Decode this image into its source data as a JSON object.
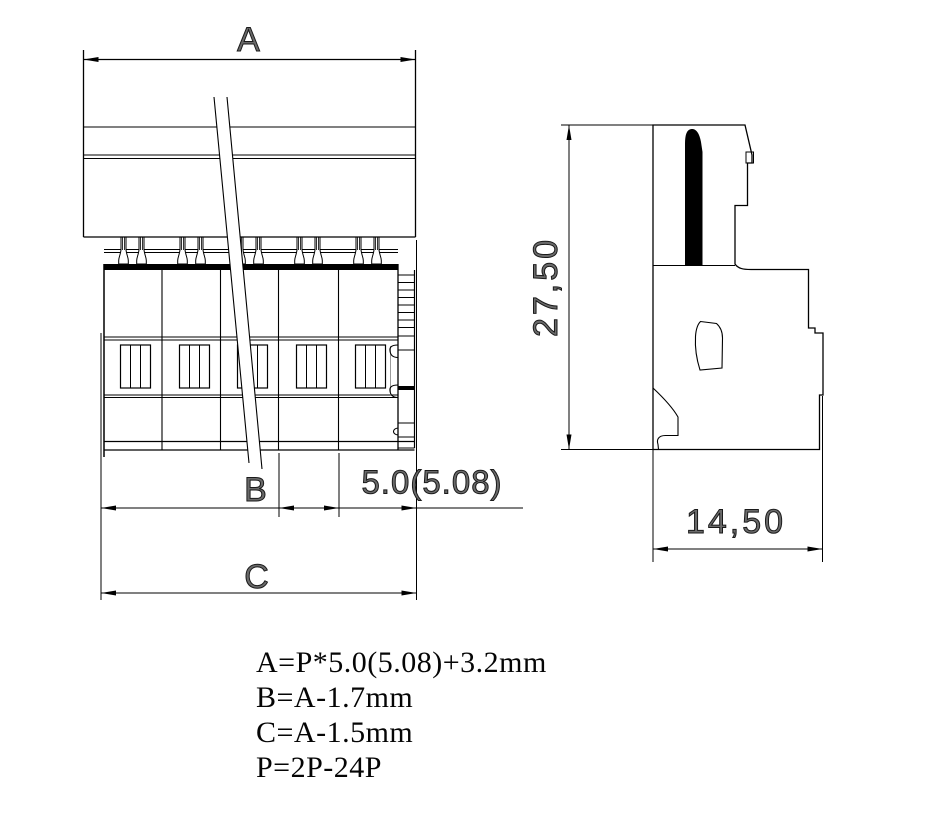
{
  "drawing": {
    "dimensions": {
      "a": "A",
      "b": "B",
      "c": "C",
      "pitch": "5.0(5.08)",
      "height": "27,50",
      "depth": "14,50"
    },
    "formulas": [
      "A=P*5.0(5.08)+3.2mm",
      "B=A-1.7mm",
      "C=A-1.5mm",
      "P=2P-24P"
    ],
    "colors": {
      "line": "#000000",
      "background": "#ffffff"
    }
  }
}
